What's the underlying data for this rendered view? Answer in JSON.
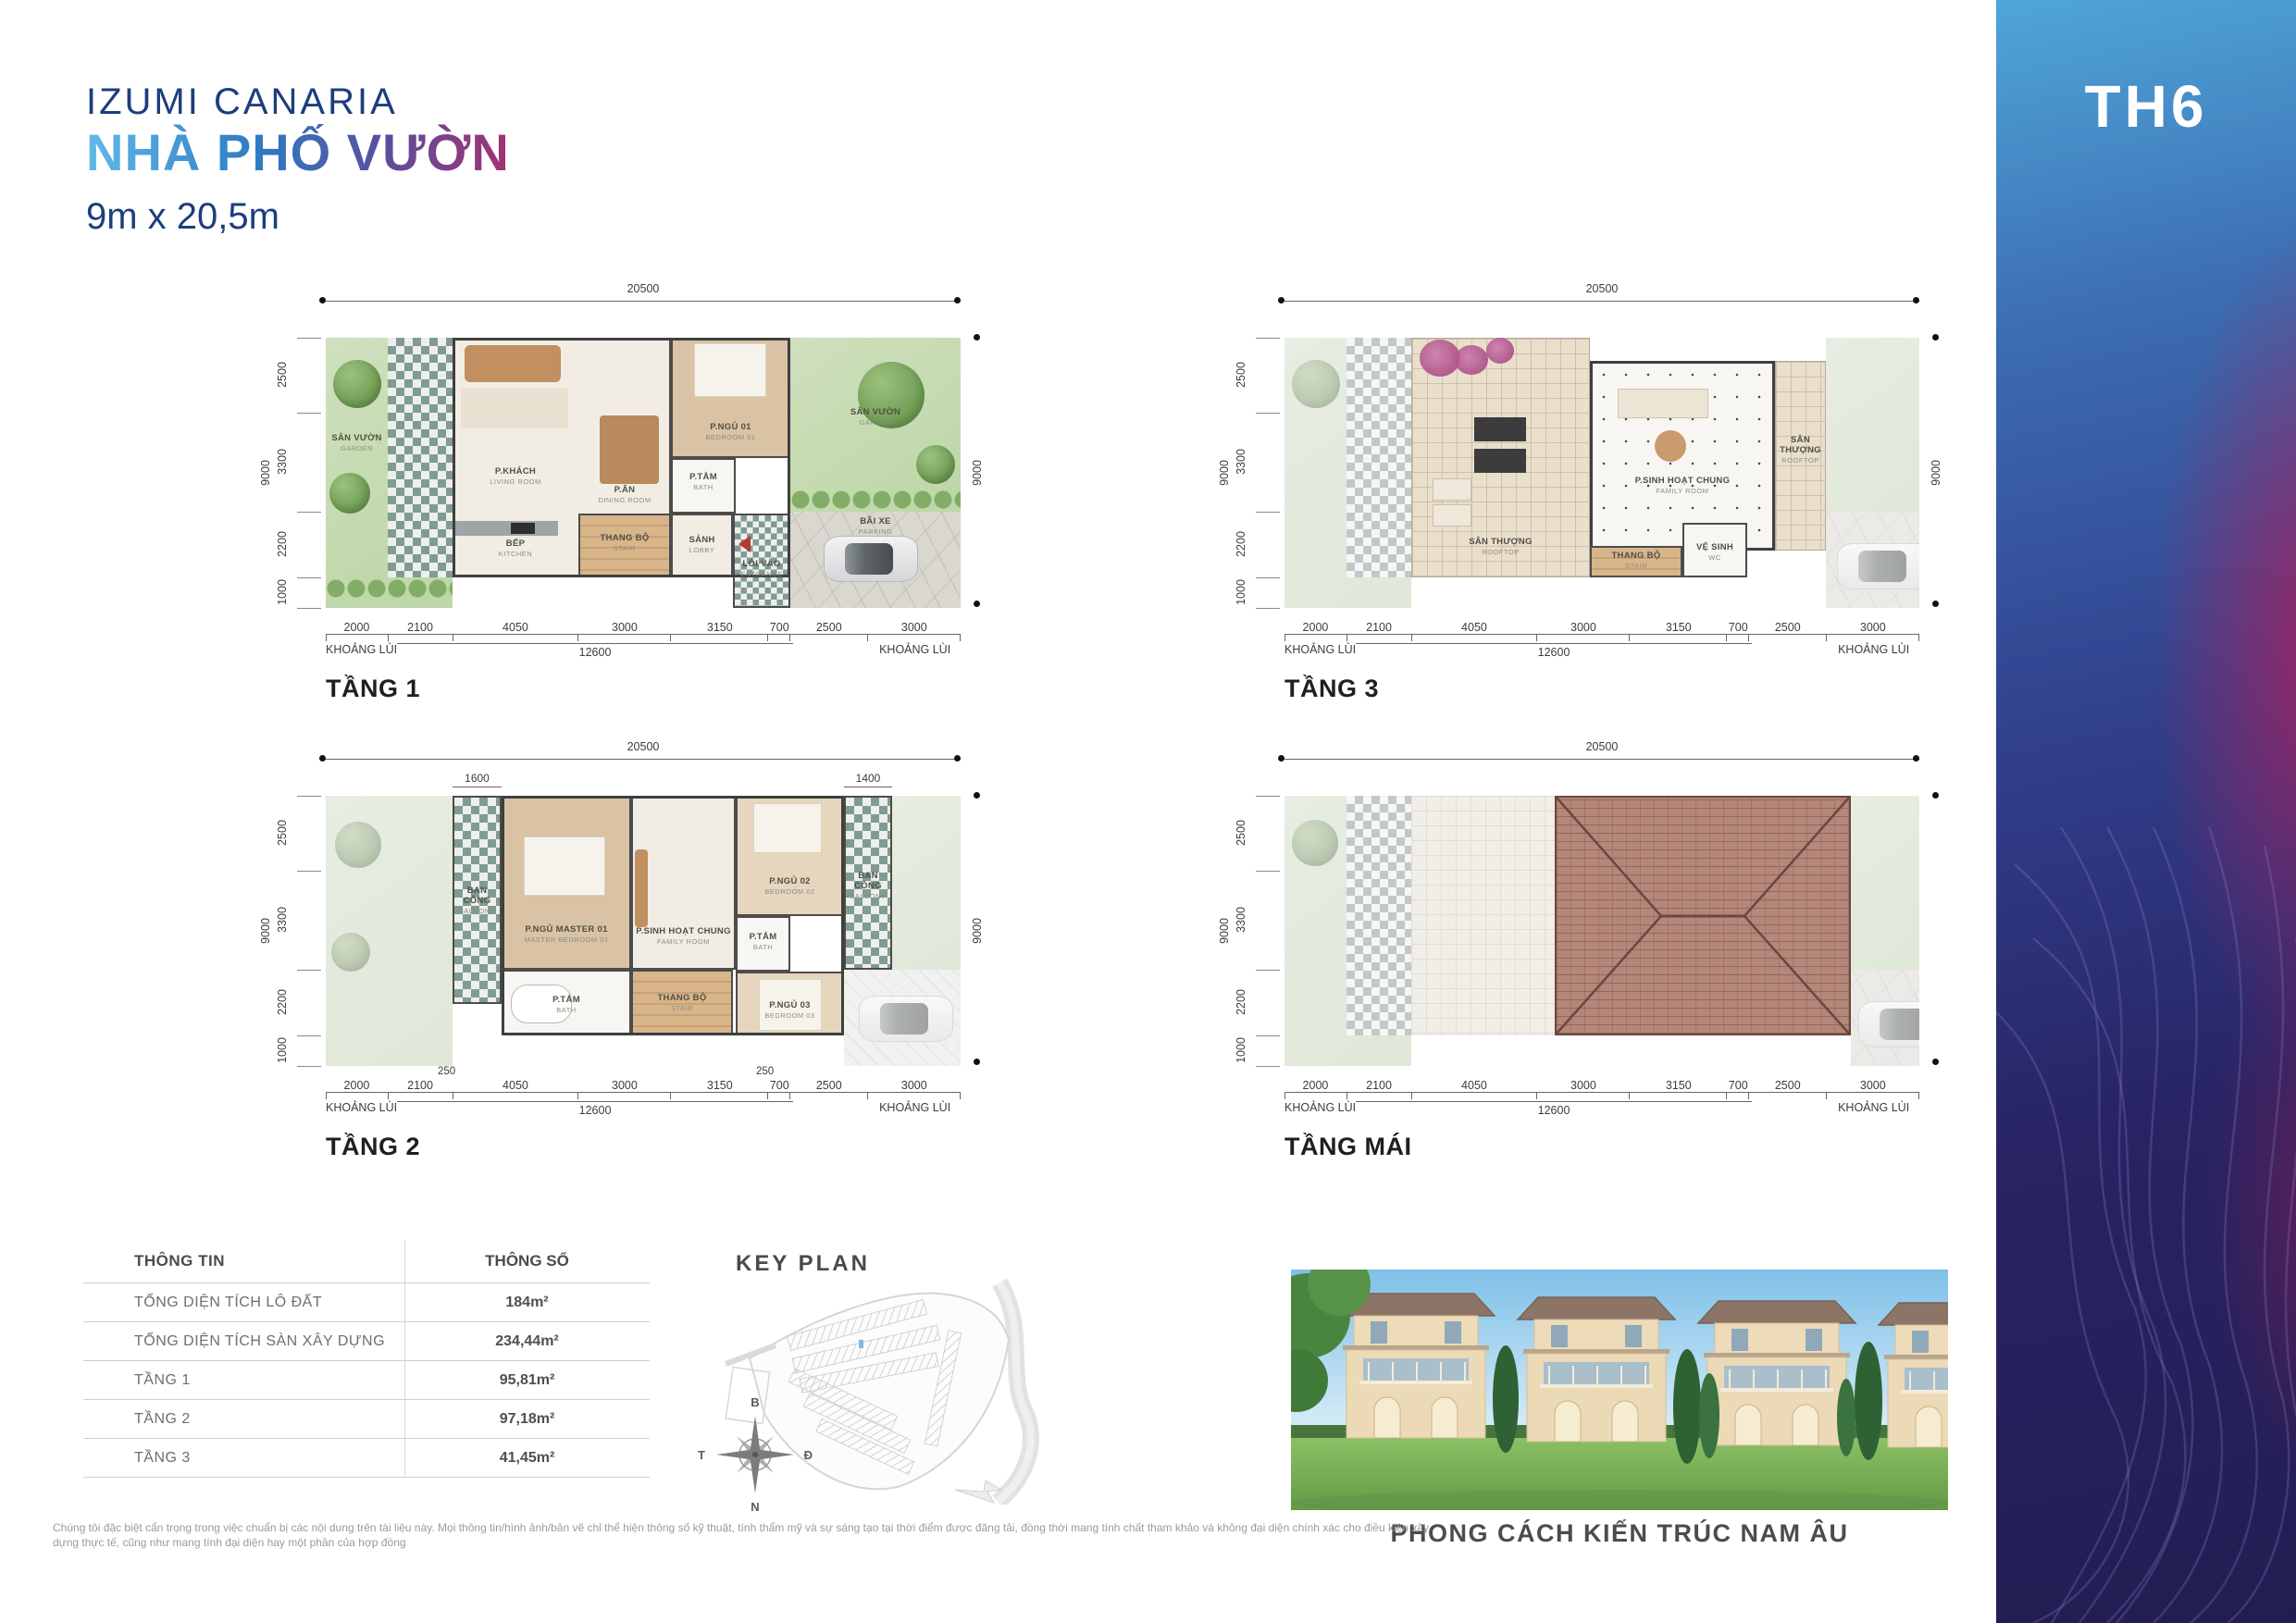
{
  "header": {
    "brand": "IZUMI CANARIA",
    "title": "NHÀ PHỐ VƯỜN",
    "size": "9m x 20,5m"
  },
  "sidebar": {
    "code": "TH6"
  },
  "dims": {
    "total": "20500",
    "side": "9000",
    "v1": "2500",
    "v2": "3300",
    "v3": "2200",
    "v4": "1000",
    "b1": "2000",
    "b2": "2100",
    "b3": "4050",
    "b4": "3000",
    "b5": "3150",
    "b6": "700",
    "b7": "2500",
    "b8": "3000",
    "sub": "12600",
    "setback": "KHOẢNG LÙI",
    "f2_left": "1600",
    "f2_right": "1400",
    "f2_small": "250"
  },
  "floors": {
    "f1": {
      "caption": "TẦNG 1"
    },
    "f2": {
      "caption": "TẦNG 2"
    },
    "f3": {
      "caption": "TẦNG 3"
    },
    "roof": {
      "caption": "TẦNG MÁI"
    }
  },
  "rooms": {
    "garden": {
      "vn": "SÂN VƯỜN",
      "en": "GARDEN"
    },
    "living": {
      "vn": "P.KHÁCH",
      "en": "LIVING ROOM"
    },
    "dining": {
      "vn": "P.ĂN",
      "en": "DINING ROOM"
    },
    "kitchen": {
      "vn": "BẾP",
      "en": "KITCHEN"
    },
    "stair": {
      "vn": "THANG BỘ",
      "en": "STAIR"
    },
    "lobby": {
      "vn": "SẢNH",
      "en": "LOBBY"
    },
    "entrance": {
      "vn": "LỐI VÀO",
      "en": "ENTRANCE"
    },
    "bed01": {
      "vn": "P.NGỦ 01",
      "en": "BEDROOM 01"
    },
    "bath": {
      "vn": "P.TẮM",
      "en": "BATH"
    },
    "parking": {
      "vn": "BÃI XE",
      "en": "PARKING"
    },
    "balcony": {
      "vn": "BAN CÔNG",
      "en": "BALCONY"
    },
    "master": {
      "vn": "P.NGỦ MASTER 01",
      "en": "MASTER BEDROOM 01"
    },
    "family": {
      "vn": "P.SINH HOẠT CHUNG",
      "en": "FAMILY ROOM"
    },
    "bed02": {
      "vn": "P.NGỦ 02",
      "en": "BEDROOM 02"
    },
    "bed03": {
      "vn": "P.NGỦ 03",
      "en": "BEDROOM 03"
    },
    "rooftop": {
      "vn": "SÂN THƯỢNG",
      "en": "ROOFTOP"
    },
    "wc": {
      "vn": "VỆ SINH",
      "en": "WC"
    }
  },
  "table": {
    "headers": [
      "THÔNG TIN",
      "THÔNG SỐ"
    ],
    "rows": [
      {
        "label": "TỔNG DIỆN TÍCH LÔ ĐẤT",
        "value": "184m²"
      },
      {
        "label": "TỔNG DIỆN TÍCH SÀN XÂY DỰNG",
        "value": "234,44m²"
      },
      {
        "label": "TẦNG 1",
        "value": "95,81m²"
      },
      {
        "label": "TẦNG 2",
        "value": "97,18m²"
      },
      {
        "label": "TẦNG 3",
        "value": "41,45m²"
      }
    ]
  },
  "keyplan": {
    "title": "KEY PLAN",
    "compass": {
      "north": "B",
      "east": "Đ",
      "south": "N",
      "west": "T"
    }
  },
  "photo": {
    "caption": "PHONG CÁCH KIẾN TRÚC NAM ÂU"
  },
  "disclaimer": {
    "text": "Chúng tôi đặc biệt cẩn trọng trong việc chuẩn bị các nội dung trên tài liệu này. Mọi thông tin/hình ảnh/bản vẽ chỉ thể hiện thông số kỹ thuật, tính thẩm mỹ và sự sáng tạo tại thời điểm được đăng tải, đồng thời mang tính chất tham khảo và không đại diện chính xác cho điều kiện xây dựng thực tế, cũng như mang tính đại diện hay một phần của hợp đồng"
  },
  "colors": {
    "navy": "#1d3d7d",
    "gradient_start": "#62b8e8",
    "gradient_end": "#a23273",
    "sidebar_top": "#4fa6da",
    "sidebar_deep": "#221d51",
    "sidebar_magenta": "#a8225e",
    "highlight_lot": "#85b7dc"
  }
}
